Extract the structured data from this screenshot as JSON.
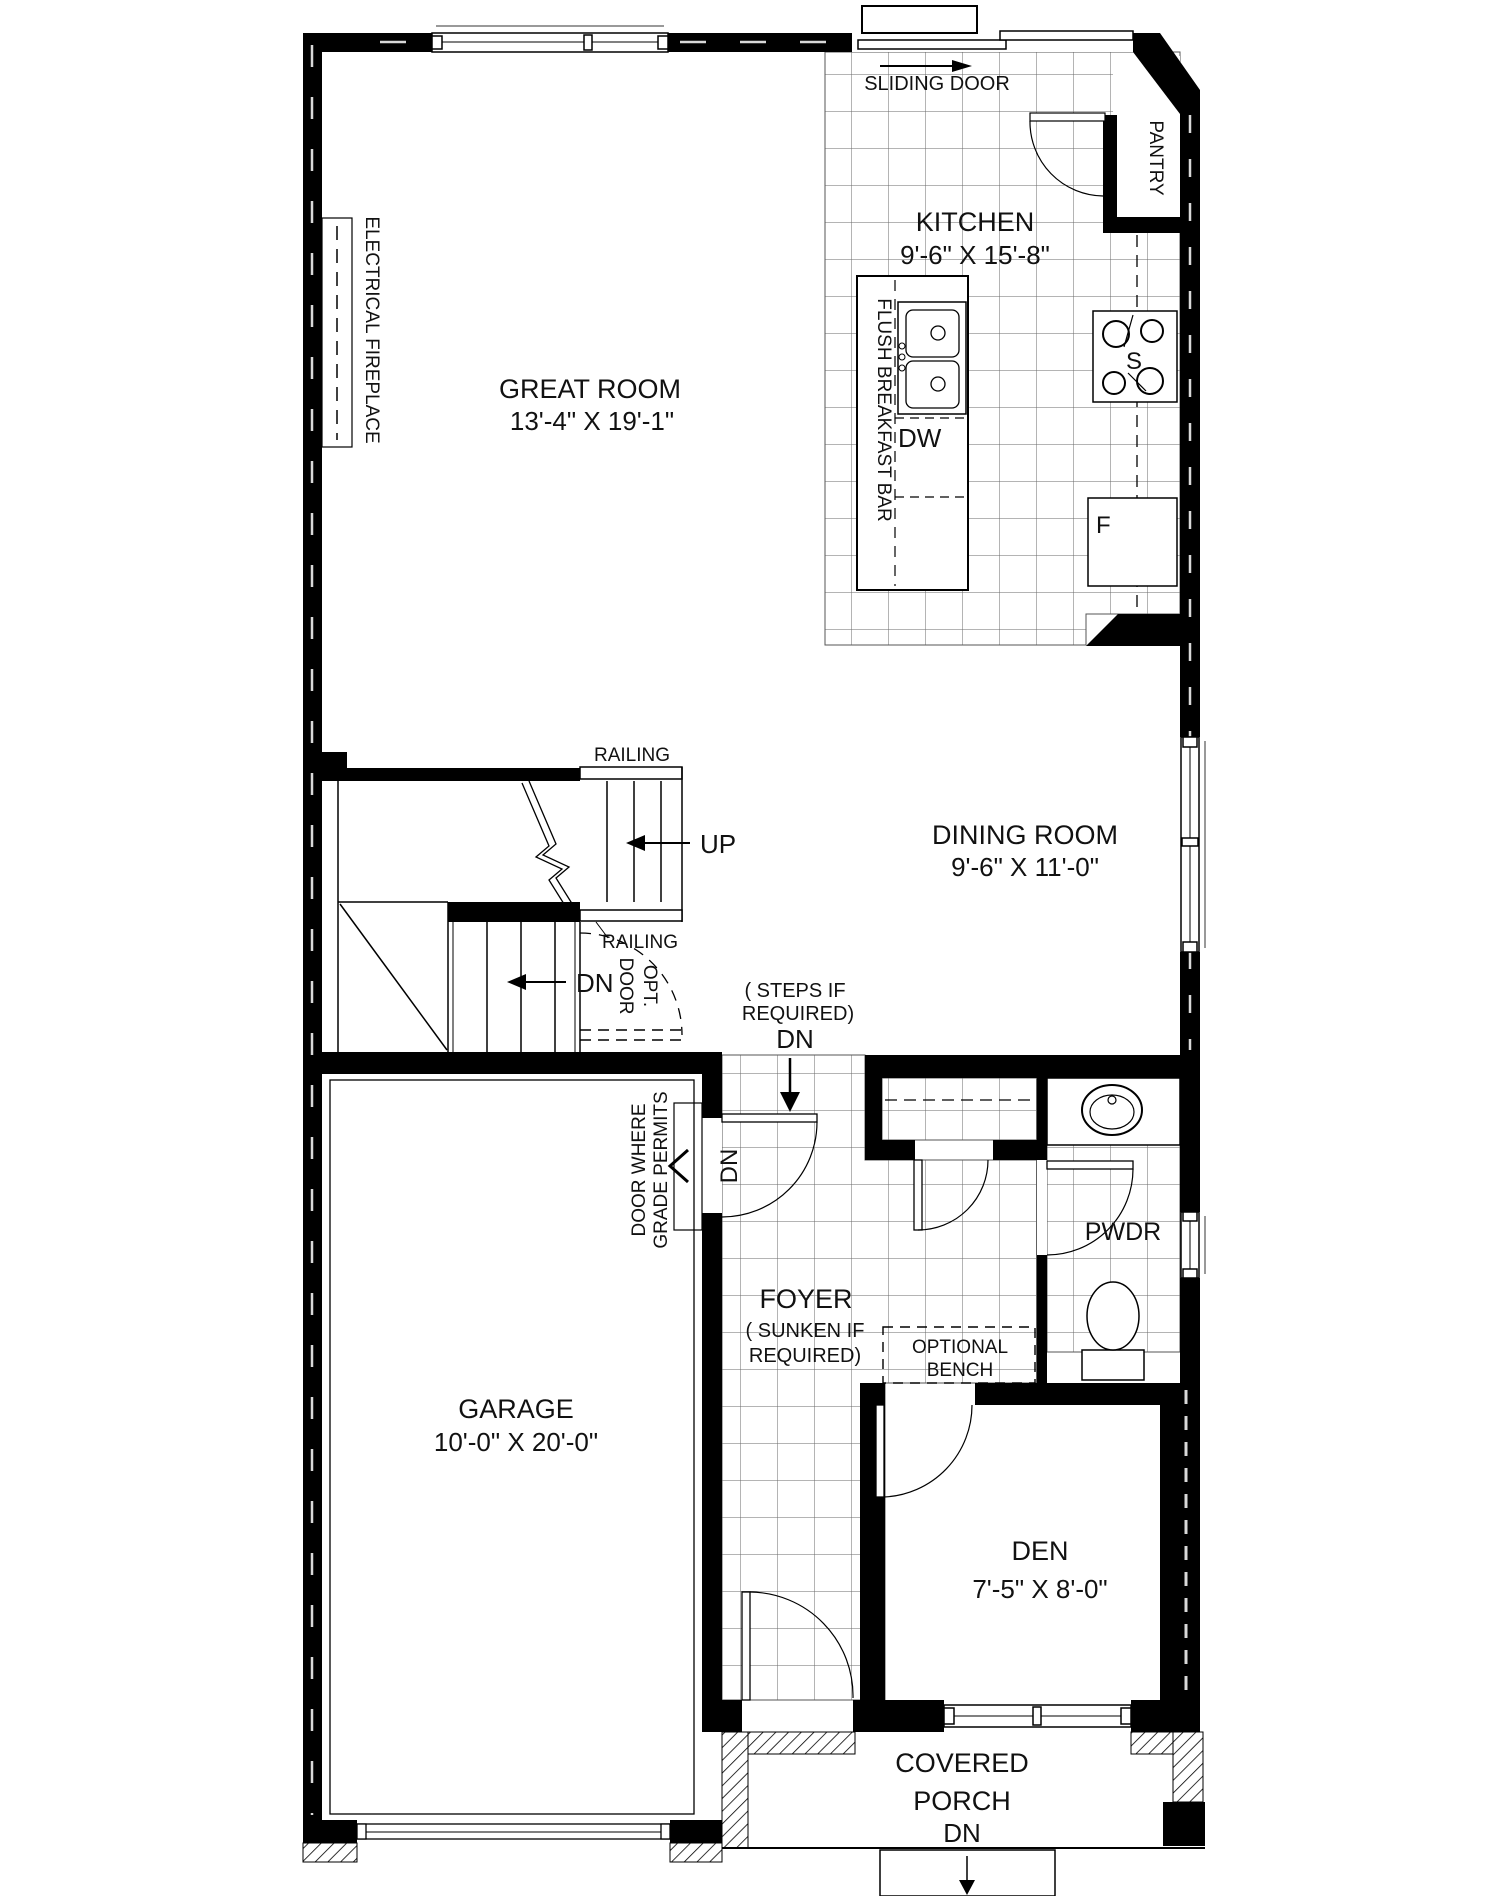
{
  "plan": {
    "rooms": {
      "great_room": {
        "name": "GREAT ROOM",
        "dims": "13'-4\" X 19'-1\""
      },
      "kitchen": {
        "name": "KITCHEN",
        "dims": "9'-6\" X 15'-8\""
      },
      "dining_room": {
        "name": "DINING ROOM",
        "dims": "9'-6\" X 11'-0\""
      },
      "garage": {
        "name": "GARAGE",
        "dims": "10'-0\" X 20'-0\""
      },
      "den": {
        "name": "DEN",
        "dims": "7'-5\" X 8'-0\""
      },
      "foyer": {
        "name": "FOYER",
        "note_line1": "( SUNKEN IF",
        "note_line2": "REQUIRED)"
      },
      "powder_room": {
        "name": "PWDR"
      },
      "pantry": {
        "name": "PANTRY"
      },
      "covered_porch": {
        "line1": "COVERED",
        "line2": "PORCH",
        "down": "DN"
      }
    },
    "labels": {
      "sliding_door": "SLIDING DOOR",
      "electrical_fireplace": "ELECTRICAL FIREPLACE",
      "flush_breakfast_bar": "FLUSH BREAKFAST BAR",
      "dishwasher": "DW",
      "stove": "S",
      "fridge": "F",
      "railing_top": "RAILING",
      "railing_mid": "RAILING",
      "up": "UP",
      "down_stairs": "DN",
      "opt_door_line1": "OPT.",
      "opt_door_line2": "DOOR",
      "steps_line1": "( STEPS IF",
      "steps_line2": "REQUIRED)",
      "steps_dn": "DN",
      "grade_door_line1": "DOOR WHERE",
      "grade_door_line2": "GRADE PERMITS",
      "grade_door_dn": "DN",
      "optional_bench_line1": "OPTIONAL",
      "optional_bench_line2": "BENCH"
    },
    "colors": {
      "wall": "#000000",
      "line": "#1a1a1a",
      "tile_line": "#555555",
      "background": "#ffffff"
    }
  }
}
